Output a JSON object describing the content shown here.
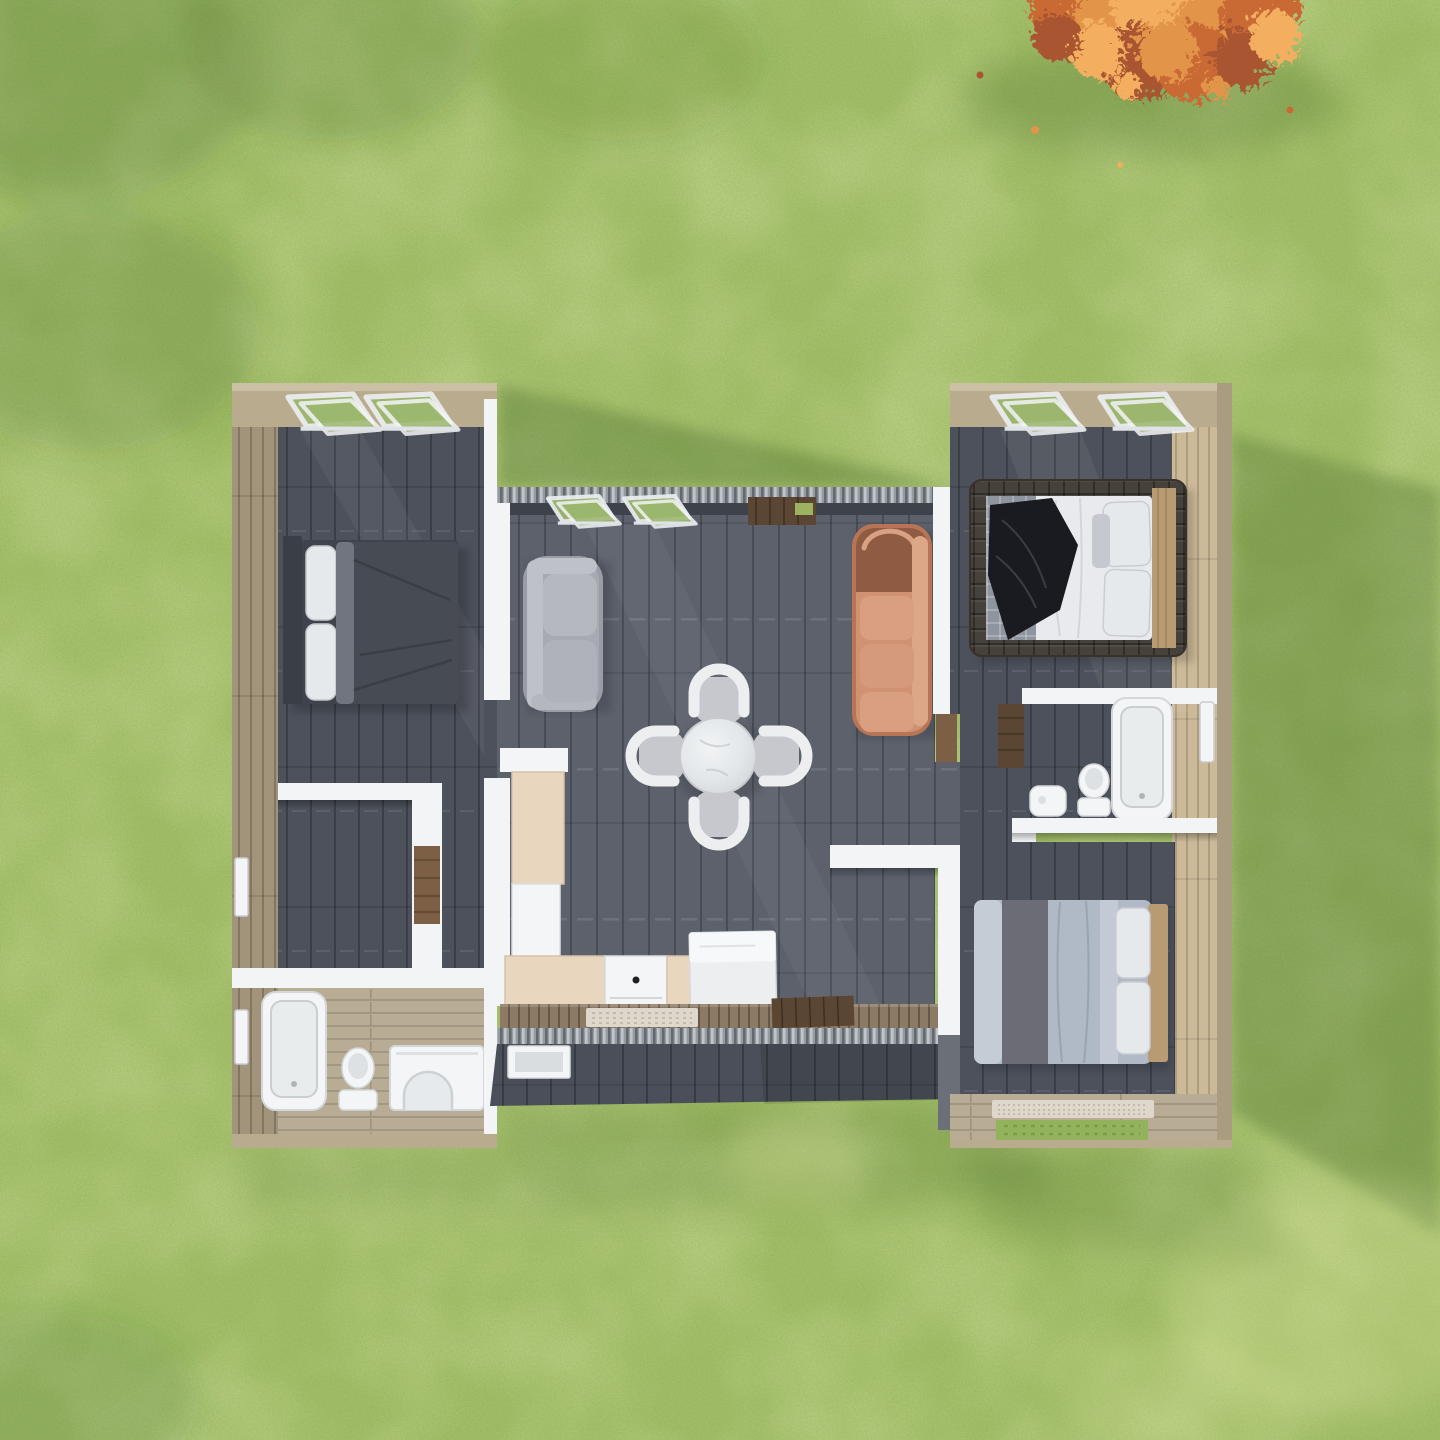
{
  "scene": {
    "type": "3d-floor-plan-render",
    "view": "top-down aerial",
    "description": "Top-down 3D render of a small single-storey house with two side wings and a recessed centre section, set on a grass lawn with an autumn tree canopy at the top right",
    "environment": {
      "ground": "grass lawn",
      "tree": "orange autumn tree canopy, top-right corner",
      "lighting": "sun from upper-left casting shadows to the lower-right"
    }
  },
  "counts": {
    "bedrooms": 3,
    "bathrooms": 2,
    "roof_windows": 6,
    "sofas": 2,
    "dining_seats": 4
  },
  "rooms": {
    "bedroom_left": {
      "label": "Bedroom 1 – left wing",
      "furniture": "double bed with dark grey duvet and white pillows, two roof windows"
    },
    "hallway_closet": {
      "label": "Hallway / closet – left wing",
      "furniture": "white partition walls with wood wardrobe panel"
    },
    "bathroom_left": {
      "label": "Bathroom 1 – left wing",
      "furniture": "bathtub, toilet, washbasin unit"
    },
    "living_dining": {
      "label": "Open living / dining room",
      "furniture": "grey loveseat, salmon three-seat sofa, round marble dining table with four chairs"
    },
    "kitchen": {
      "label": "Kitchen",
      "furniture": "L-shaped beige counter, oven, fridge"
    },
    "master_bedroom": {
      "label": "Master bedroom – right wing",
      "furniture": "double bed with quilted dark frame and black throw blanket, two roof windows"
    },
    "bathroom_right": {
      "label": "Bathroom 2 – right wing",
      "furniture": "bathtub, toilet, washbasin, wood cabinet"
    },
    "bedroom_right": {
      "label": "Bedroom 3 – right wing",
      "furniture": "double bed with blue-grey bedding, rug, wood floor border"
    },
    "deck": {
      "label": "South deck walkway",
      "furniture": "doormat, dark wood entry mat"
    },
    "lawn": {
      "label": "Grass lawn"
    },
    "tree": {
      "label": "Autumn tree canopy"
    }
  },
  "palette": {
    "grass_base": "#a3c065",
    "grass_mottle": "#b9d07c",
    "grass_shadow": "#3a5c24",
    "tree_orange_1": "#e2944a",
    "tree_orange_2": "#c96a35",
    "tree_orange_3": "#f3ae5e",
    "tree_orange_4": "#aa5530",
    "fascia_wood": "#b9ab8d",
    "fascia_edge": "#cdc2a8",
    "siding_wood": "#a2947a",
    "strip_wood": "#cbb997",
    "floor_wood": "#b8ac94",
    "deck_wood": "#8c7a64",
    "accent_wood": "#7c5f44",
    "dark_wood": "#5a4632",
    "wall_white": "#f3f4f5",
    "wall_shade": "#dcdfe1",
    "slate_center": "#5c616c",
    "slate_wing": "#4c515b",
    "south_face": "#4a4f59",
    "corrugated": "#949ba2",
    "glass_green": "#9cb76e",
    "fixture_white": "#f3f5f6",
    "sofa_salmon": "#cf9273",
    "sofa_salmon_dark": "#8f5c43",
    "sofa_salmon_light": "#dca787",
    "sofa_gray": "#a8aab3",
    "sofa_gray_light": "#bfc1c9",
    "cushion_gray": "#c6c8cd",
    "chair_white": "#eceef0",
    "table_marble": "#dfe3e6",
    "bed1_duvet": "#474b53",
    "bed1_headboard": "#3a3e46",
    "pillow_white": "#e6e9ec",
    "bed2_frame": "#46413a",
    "bed2_quilt": "#8f959f",
    "bed2_sheet": "#e8eaed",
    "bed2_blanket": "#191b20",
    "bed3_duvet": "#b0b9c6",
    "bed3_stripe": "#6c6c77",
    "bed3_sheet": "#c6ccd6",
    "headboard_wood": "#b89a73",
    "kitchen_beige": "#e9d6bf",
    "rug_cream": "#ded8cc"
  }
}
